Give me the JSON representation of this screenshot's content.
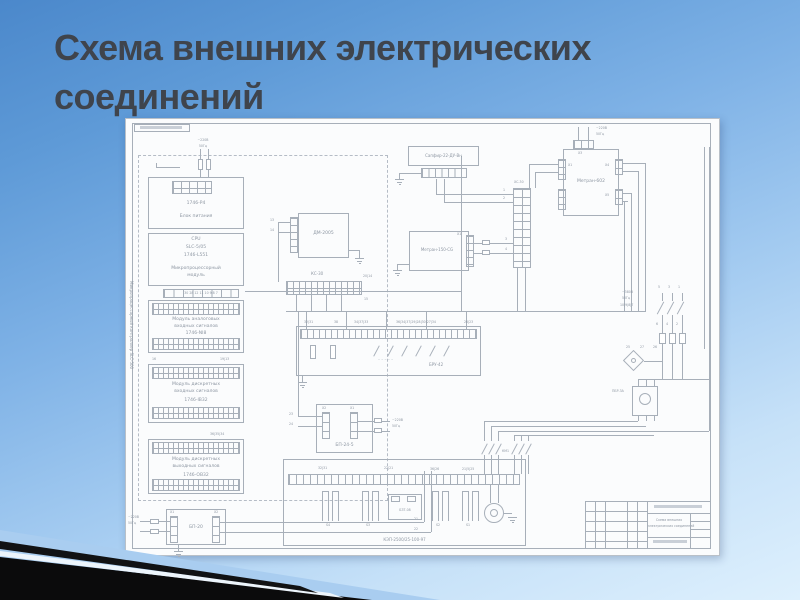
{
  "slide": {
    "title1": "Схема внешних электрических",
    "title2": "соединений"
  },
  "d": {
    "ctrl": "Микропроцессорный контроллер SLC-500",
    "p4m": "1746-P4",
    "p4n": "Блок питания",
    "cpu1": "CPU",
    "cpu2": "SLC-5/05",
    "cpu3": "1746-L551",
    "cpu4": "Микропроцессорный",
    "cpu5": "модуль",
    "ai1": "Модуль аналоговых",
    "ai2": "входных сигналов",
    "aim": "1746-NI8",
    "di1": "Модуль дискретных",
    "di2": "входных сигналов",
    "dim": "1746-IB32",
    "do1": "Модуль дискретных",
    "do2": "выходных сигналов",
    "dom": "1746-OB32",
    "bp20": "БП-20",
    "dm": "ДМ-2005",
    "ks30": "КС-30",
    "xs30": "ХС-30",
    "sapfir": "Сапфир-22-ДУ-Вн",
    "m602": "Метран-602",
    "m150": "Метран-150-CG",
    "bru": "БРУ-42",
    "bp245": "БП-24-5",
    "kep": "КЭП-2500/25-100-97",
    "bzt": "БЗТ-08",
    "pbr": "ПБР-3А",
    "km1": "КМ1",
    "motor": "М",
    "v220": "~220В",
    "hz": "50Гц",
    "v380": "~380В",
    "x1": "Х1",
    "x2": "Х2",
    "x3": "Х3",
    "x4": "Х4",
    "x5": "Х5",
    "n1": "1",
    "n2": "2",
    "n3": "3",
    "n4": "4",
    "n5": "5",
    "n6": "6",
    "n13": "13",
    "n14": "14",
    "n15": "15",
    "n16": "16",
    "n21": "21",
    "n22": "22",
    "n23": "23",
    "n24": "24",
    "n25": "25",
    "n26": "26",
    "n27": "27",
    "g2014": "20|14",
    "g1913": "19|13",
    "g363534": "36|35|34",
    "cpurow": "30 28 12 11 10 9 8 7",
    "bru1": "32|31",
    "bru2": "38",
    "bru3": "34|37|33",
    "bru4": "36|34|37|29|28|30|27|34",
    "bru5": "26|23",
    "kep2": "22|21",
    "kep3": "36|26",
    "kep4": "21|5|25",
    "m602row": "10|9|8|7",
    "s1": "S1",
    "s2": "S2",
    "s3": "S3",
    "s4": "S4",
    "dashes": "– – – – –",
    "tb1": "Схема внешних",
    "tb2": "электрических соединений"
  }
}
